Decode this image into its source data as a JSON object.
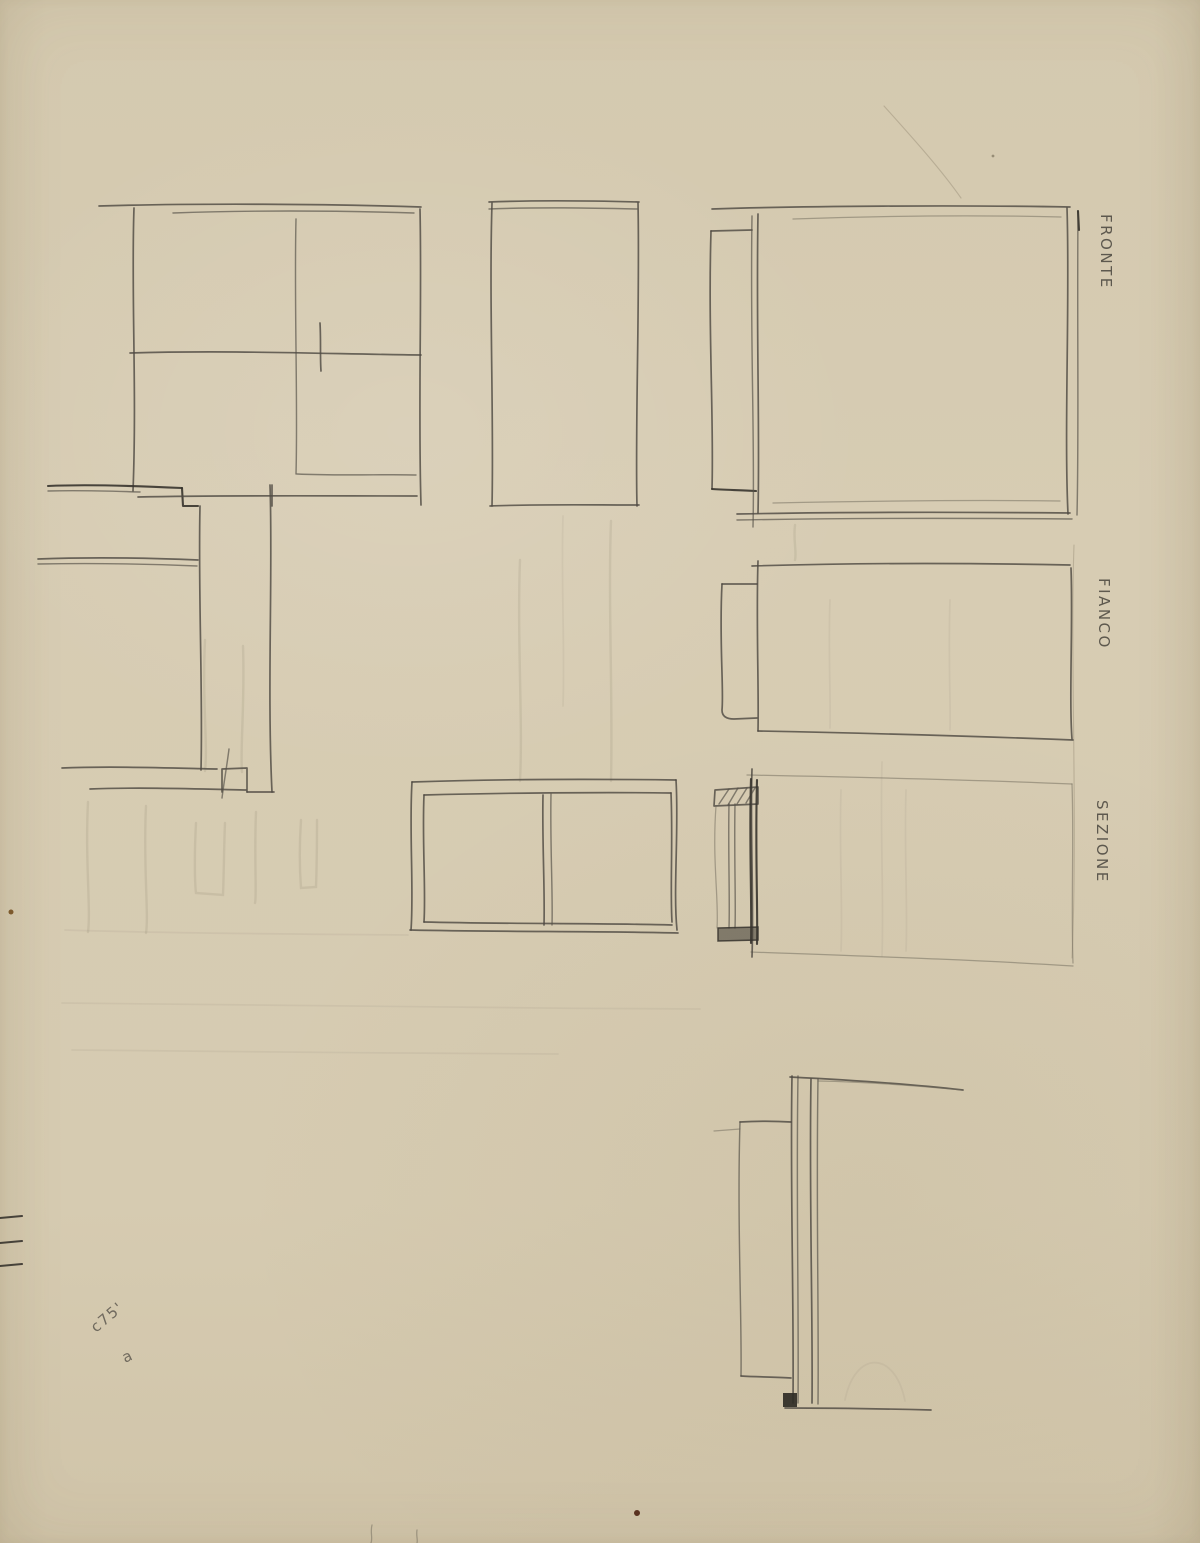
{
  "page": {
    "type": "sketch-sheet",
    "medium": "pencil on tan paper",
    "subject": "furniture design orthographic study sketches"
  },
  "labels": {
    "fronte": "FRONTE",
    "fianco": "FIANCO",
    "sezione": "SEZIONE"
  },
  "annotations": {
    "corner_note": "c75'",
    "letter_note": "a"
  },
  "colors": {
    "paper": "#d6cbb1",
    "pencil": "#4f4b43",
    "pencil_dark": "#37342e",
    "pencil_faint": "#7a735f",
    "foot_block_fill": "#2f2c26",
    "speck_brown": "#7d5a2d",
    "speck_dark": "#5a3220"
  }
}
